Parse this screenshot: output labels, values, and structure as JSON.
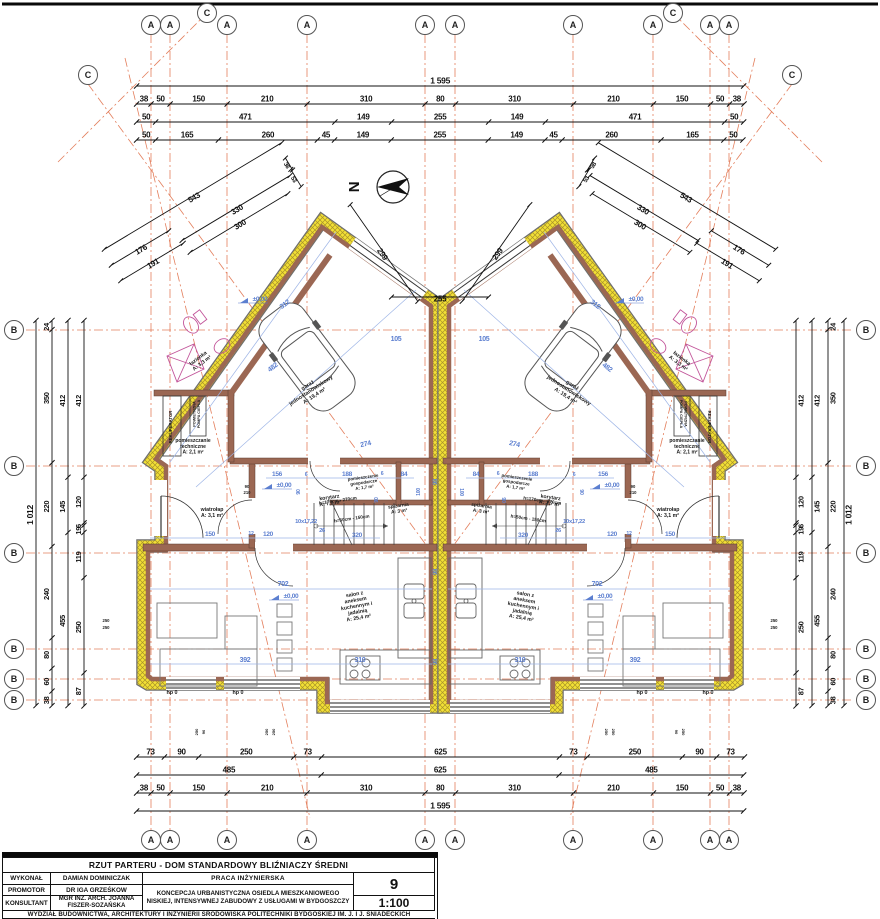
{
  "colors": {
    "insulation": "#f2e035",
    "insulation_hatch": "#a8922a",
    "wall_brown": "#9b6753",
    "grid_orange": "#e0714b",
    "dim_blue": "#5c7fd0",
    "fixture_magenta": "#c2559a",
    "line_black": "#111111"
  },
  "strings": {
    "north": "N",
    "level": "±0,00"
  },
  "axes": {
    "top": [
      {
        "x": 151,
        "l": "A"
      },
      {
        "x": 170,
        "l": "A"
      },
      {
        "x": 207,
        "l": "C",
        "raised": true
      },
      {
        "x": 227,
        "l": "A"
      },
      {
        "x": 307,
        "l": "A"
      },
      {
        "x": 425,
        "l": "A"
      },
      {
        "x": 455,
        "l": "A"
      },
      {
        "x": 573,
        "l": "A"
      },
      {
        "x": 653,
        "l": "A"
      },
      {
        "x": 673,
        "l": "C",
        "raised": true
      },
      {
        "x": 710,
        "l": "A"
      },
      {
        "x": 729,
        "l": "A"
      }
    ],
    "bottom": [
      {
        "x": 151,
        "l": "A"
      },
      {
        "x": 170,
        "l": "A"
      },
      {
        "x": 227,
        "l": "A"
      },
      {
        "x": 307,
        "l": "A"
      },
      {
        "x": 425,
        "l": "A"
      },
      {
        "x": 455,
        "l": "A"
      },
      {
        "x": 573,
        "l": "A"
      },
      {
        "x": 653,
        "l": "A"
      },
      {
        "x": 710,
        "l": "A"
      },
      {
        "x": 729,
        "l": "A"
      }
    ],
    "left": [
      {
        "y": 330,
        "l": "B"
      },
      {
        "y": 466,
        "l": "B"
      },
      {
        "y": 553,
        "l": "B"
      },
      {
        "y": 649,
        "l": "B"
      },
      {
        "y": 679,
        "l": "B"
      },
      {
        "y": 700,
        "l": "B"
      }
    ],
    "right": [
      {
        "y": 330,
        "l": "B"
      },
      {
        "y": 466,
        "l": "B"
      },
      {
        "y": 553,
        "l": "B"
      },
      {
        "y": 649,
        "l": "B"
      },
      {
        "y": 679,
        "l": "B"
      },
      {
        "y": 700,
        "l": "B"
      }
    ],
    "corners": [
      {
        "x": 88,
        "y": 75,
        "l": "C"
      },
      {
        "x": 792,
        "y": 75,
        "l": "C"
      }
    ]
  },
  "dims": {
    "top": [
      [
        1595
      ],
      [
        38,
        50,
        150,
        210,
        310,
        80,
        310,
        210,
        150,
        50,
        38
      ],
      [
        50,
        471,
        149,
        255,
        149,
        471,
        50
      ],
      [
        50,
        165,
        260,
        45,
        149,
        255,
        149,
        45,
        260,
        165,
        50
      ]
    ],
    "bottom": [
      [
        73,
        90,
        250,
        73,
        625,
        73,
        250,
        90,
        73
      ],
      [
        485,
        625,
        485
      ],
      [
        38,
        50,
        150,
        210,
        310,
        80,
        310,
        210,
        150,
        50,
        38
      ],
      [
        1595
      ]
    ],
    "left": [
      [
        1012
      ],
      [
        24,
        350,
        220,
        240,
        80,
        60,
        38
      ],
      [
        412,
        145,
        455
      ],
      [
        412,
        120,
        6,
        19,
        119,
        250,
        87
      ]
    ],
    "diag": [
      {
        "t": "543",
        "cx": 193,
        "cy": 196,
        "len": 207,
        "ang": -31
      },
      {
        "t": "330",
        "cx": 236,
        "cy": 208,
        "len": 126,
        "ang": -31
      },
      {
        "t": "300",
        "cx": 239,
        "cy": 223,
        "len": 114,
        "ang": -31
      },
      {
        "t": "176",
        "cx": 140,
        "cy": 248,
        "len": 67,
        "ang": -31
      },
      {
        "t": "191",
        "cx": 152,
        "cy": 262,
        "len": 73,
        "ang": -31
      },
      {
        "t": "38",
        "cx": 289,
        "cy": 164,
        "len": 14,
        "ang": 59,
        "fs": 6
      },
      {
        "t": "53",
        "cx": 296,
        "cy": 178,
        "len": 20,
        "ang": 59,
        "fs": 6
      },
      {
        "t": "299",
        "cx": 384,
        "cy": 253,
        "len": 118,
        "ang": 55
      },
      {
        "t": "255",
        "cx": 440,
        "cy": 297,
        "len": 97,
        "ang": 0,
        "noMirror": true
      }
    ]
  },
  "plan_labels": [
    {
      "lines": [
        "łazienka",
        "A: 3,3 m²"
      ],
      "x": 201,
      "y": 362,
      "r": -37,
      "c": "rm",
      "fs": 5.2
    },
    {
      "lines": [
        "pomieszczanie",
        "techniczne",
        "A: 2,1 m²"
      ],
      "x": 193,
      "y": 448,
      "c": "rm",
      "fs": 5
    },
    {
      "lines": [
        "garaż",
        "jednostanowiskowy",
        "A: 19,4 m²"
      ],
      "x": 312,
      "y": 392,
      "r": -33,
      "c": "rm",
      "fs": 5.4
    },
    {
      "lines": [
        "wiatrołap",
        "A: 3,1 m²"
      ],
      "x": 212,
      "y": 514,
      "c": "rm",
      "fs": 5.2
    },
    {
      "lines": [
        "korytarz",
        "A: 7,7 m²"
      ],
      "x": 330,
      "y": 502,
      "r": -8,
      "c": "rm",
      "fs": 5.2
    },
    {
      "lines": [
        "pomieszczenie",
        "gospodarcze",
        "A: 1,7 m²"
      ],
      "x": 364,
      "y": 484,
      "r": -8,
      "c": "rm",
      "fs": 4.4
    },
    {
      "lines": [
        "spiżarnia",
        "A: 3 m²"
      ],
      "x": 399,
      "y": 510,
      "r": -8,
      "c": "rm",
      "fs": 4.8
    },
    {
      "lines": [
        "salon z",
        "aneksem",
        "kuchennym i",
        "jadalnią",
        "A: 25,4 m²"
      ],
      "x": 357,
      "y": 608,
      "r": -10,
      "c": "rm",
      "fs": 5.2
    },
    {
      "t": "REKUPERATOR",
      "x": 172,
      "y": 427,
      "r": -90,
      "c": "rm",
      "fs": 4.3
    },
    {
      "lines": [
        "POWIETRZNA",
        "POMPA CIEPŁA"
      ],
      "x": 198,
      "y": 414,
      "r": -90,
      "c": "rm",
      "fs": 3.8
    },
    {
      "t": "h=170cm - 270cm",
      "x": 338,
      "y": 502,
      "r": -8,
      "c": "rm",
      "fs": 4.6
    },
    {
      "t": "h=50cm - 150cm",
      "x": 352,
      "y": 520,
      "r": -8,
      "c": "rm",
      "fs": 4.6
    },
    {
      "t": "hp 0",
      "x": 172,
      "y": 694,
      "c": "rm",
      "fs": 5.4
    },
    {
      "t": "hp 0",
      "x": 238,
      "y": 694,
      "c": "rm",
      "fs": 5.4
    },
    {
      "t": "482",
      "x": 274,
      "y": 369,
      "r": -37,
      "c": "bl",
      "fs": 7
    },
    {
      "t": "312",
      "x": 286,
      "y": 306,
      "r": -37,
      "c": "bl",
      "fs": 7
    },
    {
      "t": "105",
      "x": 396,
      "y": 341,
      "c": "bl",
      "fs": 7
    },
    {
      "t": "274",
      "x": 366,
      "y": 446,
      "r": -12,
      "c": "bl",
      "fs": 7
    },
    {
      "t": "156",
      "x": 277,
      "y": 476,
      "c": "bl",
      "fs": 6.5
    },
    {
      "t": "6",
      "x": 306,
      "y": 476,
      "c": "bl",
      "fs": 5.2
    },
    {
      "t": "188",
      "x": 347,
      "y": 476,
      "c": "bl",
      "fs": 6.5
    },
    {
      "t": "6",
      "x": 382,
      "y": 475,
      "c": "bl",
      "fs": 5.2
    },
    {
      "t": "84",
      "x": 404,
      "y": 476,
      "c": "bl",
      "fs": 6.5
    },
    {
      "t": "150",
      "x": 210,
      "y": 536,
      "c": "bl",
      "fs": 6.5
    },
    {
      "t": "12",
      "x": 251,
      "y": 535,
      "c": "bl",
      "fs": 5.2
    },
    {
      "t": "120",
      "x": 268,
      "y": 536,
      "c": "bl",
      "fs": 6.5
    },
    {
      "t": "320",
      "x": 357,
      "y": 537,
      "c": "bl",
      "fs": 6.5
    },
    {
      "t": "10x17,22",
      "x": 306,
      "y": 523,
      "c": "bl",
      "fs": 5.8
    },
    {
      "t": "26",
      "x": 322,
      "y": 532,
      "c": "bl",
      "fs": 5.8
    },
    {
      "t": "702",
      "x": 283,
      "y": 586,
      "c": "bl",
      "fs": 7
    },
    {
      "t": "392",
      "x": 245,
      "y": 662,
      "c": "bl",
      "fs": 7
    },
    {
      "t": "310",
      "x": 360,
      "y": 662,
      "c": "bl",
      "fs": 7
    },
    {
      "t": "100",
      "x": 420,
      "y": 492,
      "r": -90,
      "c": "bl",
      "fs": 5.2
    },
    {
      "t": "90",
      "x": 378,
      "y": 500,
      "r": -90,
      "c": "bl",
      "fs": 5.2
    },
    {
      "t": "90",
      "x": 300,
      "y": 492,
      "r": -90,
      "c": "bl",
      "fs": 5.2
    },
    {
      "t": "98",
      "x": 437,
      "y": 482,
      "r": -90,
      "c": "bl",
      "fs": 6,
      "noMirror": true
    },
    {
      "t": "98",
      "x": 437,
      "y": 572,
      "r": -90,
      "c": "bl",
      "fs": 6,
      "noMirror": true
    },
    {
      "t": "98",
      "x": 437,
      "y": 662,
      "r": -90,
      "c": "bl",
      "fs": 6,
      "noMirror": true
    },
    {
      "t": "90",
      "x": 247,
      "y": 488,
      "c": "rm",
      "fs": 4.2
    },
    {
      "t": "210",
      "x": 247,
      "y": 494,
      "c": "rm",
      "fs": 4.2
    },
    {
      "t": "250",
      "x": 106,
      "y": 622,
      "c": "rm",
      "fs": 4.2
    },
    {
      "t": "250",
      "x": 106,
      "y": 629,
      "c": "rm",
      "fs": 4.2
    },
    {
      "t": "250",
      "x": 198,
      "y": 732,
      "r": -90,
      "c": "rm",
      "fs": 4
    },
    {
      "t": "90",
      "x": 205,
      "y": 732,
      "r": -90,
      "c": "rm",
      "fs": 4
    },
    {
      "t": "250",
      "x": 268,
      "y": 732,
      "r": -90,
      "c": "rm",
      "fs": 4
    },
    {
      "t": "250",
      "x": 275,
      "y": 732,
      "r": -90,
      "c": "rm",
      "fs": 4
    }
  ],
  "levels": [
    {
      "x": 252,
      "y": 303
    },
    {
      "x": 276,
      "y": 489
    },
    {
      "x": 283,
      "y": 600
    }
  ],
  "titleblock": {
    "title": "RZUT PARTERU  -  DOM STANDARDOWY BLIŹNIACZY ŚREDNI",
    "rows": [
      {
        "label": "WYKONAŁ",
        "value": "DAMIAN DOMINICZAK"
      },
      {
        "label": "PROMOTOR",
        "value": "DR IGA GRZEŚKOW"
      },
      {
        "label": "KONSULTANT",
        "value": "MGR INŻ. ARCH. JOANNA FISZER-SOZAŃSKA"
      }
    ],
    "praca": "PRACA INŻYNIERSKA",
    "koncepcja": "KONCEPCJA URBANISTYCZNA OSIEDLA MIESZKANIOWEGO NISKIEJ, INTENSYWNEJ ZABUDOWY Z USŁUGAMI W BYDGOSZCZY",
    "sheet_no": "9",
    "scale": "1:100",
    "footer": "WYDZIAŁ BUDOWNICTWA, ARCHITEKTURY I INŻYNIERII ŚRODOWISKA POLITECHNIKI BYDGOSKIEJ IM. J. I J. ŚNIADECKICH"
  }
}
